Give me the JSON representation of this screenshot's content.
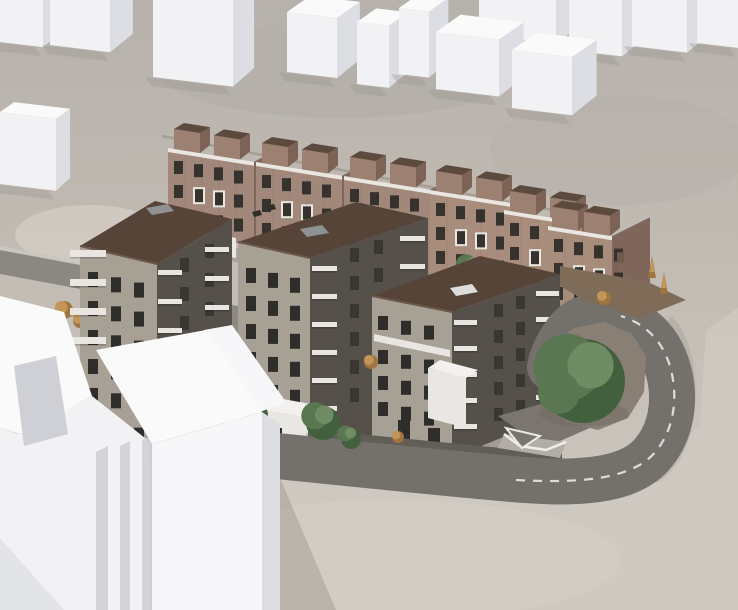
{
  "scene": {
    "canvas": {
      "w": 738,
      "h": 610
    },
    "description": "aerial architectural rendering of housing development with three stone apartment buildings, townhouse row, white context blocks and curved road",
    "palette": {
      "terrain_top": "#b5b0aa",
      "terrain_base": "#c2bcb4",
      "terrain_bottom": "#cfc9c1",
      "terrain_light": "#d6d0c8",
      "slope_shade": "#a8a29a",
      "road": "#74716c",
      "road_wall": "#cac6c0",
      "road_upper": "#8b8781",
      "lane": "#ebe9e4",
      "apron": "#615d57",
      "plaza": "#7a766f",
      "white_top": "#fafafb",
      "white_front": "#f2f2f4",
      "white_front2": "#f7f7f9",
      "white_side": "#dddee3",
      "white_recess": "#cfd0d6",
      "block_shadow": "#99948c",
      "stone_lit": "#a7a095",
      "stone_shade": "#55504a",
      "apt_roof": "#564438",
      "apt_roof_edge": "#6b5849",
      "win": "#2f2d2a",
      "win_shade": "#3a3733",
      "balcony": "#e9e6e1",
      "skylight": "#8f9192",
      "skylight_white": "#dcdcda",
      "th_front": "#a1887a",
      "th_front_warm": "#a98d7c",
      "th_side": "#7e665b",
      "th_deck": "#eae7e2",
      "th_box_top": "#5d4a3f",
      "th_box_front": "#9c8071",
      "th_box_side": "#7c6356",
      "th_win": "#36322e",
      "deck_grey": "#8d8982",
      "lowvol": "#e9e7e3",
      "lowvol_top": "#f2f1ee",
      "island_dirt": "#897f75",
      "strip_dirt": "#7e6c58",
      "g_dark": "#43603e",
      "g_mid": "#5a7751",
      "g_light": "#708c62",
      "a_dark": "#a0743f",
      "a_light": "#c29659",
      "trunk": "#4a3f35",
      "shadow_soft": "#8d887f",
      "ramp": "#b2ada5"
    },
    "terrain": {
      "patches": [
        {
          "e": [
            340,
            70,
            180,
            48
          ],
          "fill": "terrain_top",
          "op": 0.9
        },
        {
          "e": [
            620,
            150,
            130,
            55
          ],
          "fill": "terrain_top",
          "op": 0.6
        },
        {
          "e": [
            90,
            235,
            75,
            30
          ],
          "fill": "terrain_light",
          "op": 0.7
        },
        {
          "e": [
            120,
            520,
            110,
            45
          ],
          "fill": "terrain_light",
          "op": 0.4
        },
        {
          "e": [
            390,
            560,
            230,
            60
          ],
          "fill": "terrain_light",
          "op": 0.45
        }
      ],
      "bottom_field": "0,468 230,452 400,472 545,492 650,482 700,424 706,330 738,308 738,610 0,610",
      "slope_streak": "M 668,320 C 690,345 696,395 682,440 C 676,458 666,470 654,478"
    },
    "upper_road": {
      "wall": "0,246 86,262 86,266 0,250",
      "body": "0,250 86,266 86,290 0,274"
    },
    "context_blocks": [
      {
        "x": 479,
        "y": -20,
        "w": 77,
        "h": 55,
        "d": 26
      },
      {
        "x": 569,
        "y": -14,
        "w": 53,
        "h": 64,
        "d": 26
      },
      {
        "x": 632,
        "y": -16,
        "w": 55,
        "h": 62,
        "d": 26
      },
      {
        "x": 697,
        "y": -15,
        "w": 41,
        "h": 58,
        "d": 26
      },
      {
        "x": 0,
        "y": -8,
        "w": 43,
        "h": 50,
        "d": 24
      },
      {
        "x": 50,
        "y": -12,
        "w": 60,
        "h": 57,
        "d": 26
      },
      {
        "x": 153,
        "y": -18,
        "w": 80,
        "h": 95,
        "d": 24
      },
      {
        "x": 287,
        "y": 12,
        "w": 50,
        "h": 60,
        "d": 26
      },
      {
        "x": 357,
        "y": 22,
        "w": 32,
        "h": 62,
        "d": 22
      },
      {
        "x": 399,
        "y": 8,
        "w": 30,
        "h": 66,
        "d": 22
      },
      {
        "x": 436,
        "y": 32,
        "w": 63,
        "h": 57,
        "d": 28
      },
      {
        "x": 512,
        "y": 50,
        "w": 60,
        "h": 58,
        "d": 28
      },
      {
        "x": 0,
        "y": 112,
        "w": 56,
        "h": 72,
        "d": 16
      }
    ],
    "fence": {
      "x1": 162,
      "y1": 136,
      "x2": 552,
      "y2": 210
    },
    "townhouses": [
      {
        "x": 168,
        "y": 148,
        "w": 86,
        "h": 84,
        "d": 22,
        "warm": false
      },
      {
        "x": 256,
        "y": 162,
        "w": 86,
        "h": 86,
        "d": 22,
        "warm": false
      },
      {
        "x": 344,
        "y": 176,
        "w": 86,
        "h": 88,
        "d": 22,
        "warm": false
      },
      {
        "x": 430,
        "y": 190,
        "w": 84,
        "h": 88,
        "d": 22,
        "warm": true
      },
      {
        "x": 504,
        "y": 210,
        "w": 78,
        "h": 88,
        "d": 20,
        "warm": true
      },
      {
        "x": 548,
        "y": 226,
        "w": 64,
        "h": 92,
        "d": 38,
        "warm": true,
        "boff": [
          4,
          36
        ]
      }
    ],
    "terrace": "610,318 660,298 660,308 610,328",
    "row_shadow": "168,236 552,304 552,318 168,250",
    "courtyard": {
      "deckA": "158,290 248,308 248,346 158,328",
      "deckB": "428,302 468,314 468,368 428,356",
      "lowvolC": "176,226 236,238 236,258 176,246",
      "planters": [
        [
          166,
          312,
          10,
          4
        ],
        [
          180,
          318,
          12,
          4
        ],
        [
          436,
          320,
          10,
          4
        ]
      ]
    },
    "trees_back": [
      {
        "t": "g",
        "x": 212,
        "y": 248,
        "r": 10
      },
      {
        "t": "g",
        "x": 298,
        "y": 240,
        "r": 14
      },
      {
        "t": "g",
        "x": 386,
        "y": 254,
        "r": 14
      },
      {
        "t": "g",
        "x": 470,
        "y": 268,
        "r": 13
      },
      {
        "t": "g",
        "x": 524,
        "y": 306,
        "r": 14
      },
      {
        "t": "g",
        "x": 548,
        "y": 318,
        "r": 11
      },
      {
        "t": "a",
        "x": 170,
        "y": 302,
        "r": 9
      },
      {
        "t": "a",
        "x": 189,
        "y": 295,
        "r": 7
      },
      {
        "t": "a",
        "x": 64,
        "y": 310,
        "r": 9
      },
      {
        "t": "a",
        "x": 80,
        "y": 321,
        "r": 7
      },
      {
        "t": "a",
        "x": 363,
        "y": 320,
        "r": 9
      },
      {
        "t": "a",
        "x": 447,
        "y": 333,
        "r": 8
      },
      {
        "t": "a",
        "x": 610,
        "y": 298,
        "r": 7
      },
      {
        "t": "c",
        "x": 604,
        "y": 294,
        "r": 7
      }
    ],
    "apartments": [
      {
        "name": "apartment-building-left",
        "faces": [
          {
            "pts": "80,246 157,264 157,466 80,448",
            "fill": "stone_lit"
          },
          {
            "pts": "157,264 232,219 232,419 157,466",
            "fill": "stone_shade"
          },
          {
            "pts": "157,264 80,246 155,201 232,219",
            "fill": "apt_roof"
          }
        ],
        "extras": [
          {
            "line": [
              80,
              246,
              157,
              264
            ],
            "stroke": "apt_roof_edge",
            "w": 2
          },
          {
            "pts": "146,208 168,204 174,211 152,215",
            "fill": "skylight"
          }
        ],
        "windows": [
          {
            "x0": 88,
            "y0": 272,
            "cols": 3,
            "dx": 23,
            "sy": 5.3,
            "rows": 6,
            "dy": 29,
            "w": 10,
            "h": 15,
            "fill": "win"
          },
          {
            "x0": 180,
            "y0": 258,
            "cols": 2,
            "dx": 25,
            "sy": -14,
            "rows": 6,
            "dy": 29,
            "w": 9,
            "h": 14,
            "fill": "win_shade"
          }
        ],
        "slabs": [
          {
            "x": 70,
            "y": 250,
            "w": 36,
            "h": 7,
            "n": 4,
            "dy": 29
          },
          {
            "x": 158,
            "y": 270,
            "w": 24,
            "h": 5,
            "n": 6,
            "dy": 29
          },
          {
            "x": 205,
            "y": 247,
            "w": 24,
            "h": 5,
            "n": 6,
            "dy": 29
          }
        ]
      },
      {
        "name": "apartment-building-middle",
        "faces": [
          {
            "pts": "238,242 310,258 310,456 238,440",
            "fill": "stone_lit"
          },
          {
            "pts": "310,258 428,218 428,420 310,456",
            "fill": "stone_shade"
          },
          {
            "pts": "310,258 238,242 356,202 428,218",
            "fill": "apt_roof"
          }
        ],
        "extras": [
          {
            "line": [
              238,
              242,
              310,
              258
            ],
            "stroke": "apt_roof_edge",
            "w": 2
          },
          {
            "pts": "300,229 322,225 329,233 307,237",
            "fill": "skylight"
          },
          {
            "pts": "252,212 260,210 262,215 254,217",
            "fill": "win"
          },
          {
            "pts": "266,206 274,204 276,209 268,211",
            "fill": "win"
          }
        ],
        "windows": [
          {
            "x0": 246,
            "y0": 268,
            "cols": 3,
            "dx": 22,
            "sy": 4.9,
            "rows": 6,
            "dy": 28,
            "w": 10,
            "h": 15,
            "fill": "win"
          },
          {
            "x0": 350,
            "y0": 248,
            "cols": 2,
            "dx": 24,
            "sy": -8,
            "rows": 6,
            "dy": 28,
            "w": 9,
            "h": 14,
            "fill": "win_shade"
          }
        ],
        "slabs": [
          {
            "x": 312,
            "y": 266,
            "w": 25,
            "h": 5,
            "n": 6,
            "dy": 28
          },
          {
            "x": 400,
            "y": 236,
            "w": 25,
            "h": 5,
            "n": 6,
            "dy": 28
          }
        ]
      },
      {
        "name": "apartment-building-right",
        "faces": [
          {
            "pts": "372,296 452,312 452,458 372,442",
            "fill": "stone_lit"
          },
          {
            "pts": "452,312 560,274 560,414 452,458",
            "fill": "stone_shade"
          },
          {
            "pts": "452,312 372,296 480,256 560,274",
            "fill": "apt_roof"
          }
        ],
        "extras": [
          {
            "line": [
              372,
              296,
              452,
              312
            ],
            "stroke": "apt_roof_edge",
            "w": 2
          },
          {
            "pts": "450,288 472,284 478,292 456,296",
            "fill": "skylight_white"
          },
          {
            "pts": "374,334 450,350 450,357 374,341",
            "fill": "balcony"
          },
          {
            "r": [
              398,
              420,
              12,
              22
            ],
            "fill": "win"
          },
          {
            "r": [
              428,
              428,
              12,
              20
            ],
            "fill": "win"
          },
          {
            "pts": "452,458 560,414 572,420 462,466",
            "fill": "#4a463f",
            "op": 0.3
          }
        ],
        "windows": [
          {
            "x0": 378,
            "y0": 316,
            "cols": 3,
            "dx": 23,
            "sy": 4.8,
            "rows": 1,
            "dy": 26,
            "w": 10,
            "h": 14,
            "fill": "win"
          },
          {
            "x0": 378,
            "y0": 350,
            "cols": 3,
            "dx": 23,
            "sy": 4.8,
            "rows": 3,
            "dy": 26,
            "w": 10,
            "h": 14,
            "fill": "win"
          },
          {
            "x0": 494,
            "y0": 304,
            "cols": 2,
            "dx": 22,
            "sy": -8,
            "rows": 5,
            "dy": 26,
            "w": 9,
            "h": 13,
            "fill": "win_shade"
          }
        ],
        "slabs": [
          {
            "x": 454,
            "y": 320,
            "w": 23,
            "h": 5,
            "n": 5,
            "dy": 26
          },
          {
            "x": 536,
            "y": 291,
            "w": 23,
            "h": 5,
            "n": 5,
            "dy": 26
          }
        ]
      }
    ],
    "street": {
      "apron": "236,422 562,454 562,472 236,440",
      "lowvolA_top": "252,408 308,418 322,406 266,396",
      "lowvolA": "252,408 308,418 308,468 252,458",
      "lowvolA_door": [
        272,
        428,
        10,
        24
      ],
      "lowvolB_top": "428,368 466,378 478,370 440,360",
      "lowvolB": "428,368 466,378 466,428 428,418",
      "plaza": "498,416 562,398 608,420 544,448",
      "ramp": "504,434 566,442 560,458 498,448",
      "rail": "504,434 520,446 546,450 566,442",
      "marks": "M 506,428 L 540,436 L 522,448 Z"
    },
    "road": {
      "main": "M 226,451 C 330,461 440,473 524,480 C 590,485 634,478 654,452 C 671,431 676,401 669,373 C 662,345 646,327 622,319 C 599,311 578,317 566,333 C 557,345 552,357 550,367",
      "width": 46,
      "dash": "M 516,480 C 590,484 636,477 657,450 C 674,428 678,398 671,370 C 664,342 646,324 621,316",
      "island": "548,346 574,328 604,322 632,334 646,356 644,392 628,418 598,430 566,422 550,398 542,370",
      "strip": "560,266 648,282 686,300 640,318 584,300 560,286"
    },
    "trees_front": [
      {
        "t": "g",
        "x": 252,
        "y": 412,
        "r": 13
      },
      {
        "t": "g",
        "x": 320,
        "y": 420,
        "r": 17
      },
      {
        "t": "g",
        "x": 348,
        "y": 436,
        "r": 10
      },
      {
        "t": "a",
        "x": 398,
        "y": 437,
        "r": 6
      },
      {
        "t": "a",
        "x": 371,
        "y": 362,
        "r": 7
      },
      {
        "t": "big",
        "x": 580,
        "y": 378,
        "r": 42
      },
      {
        "t": "c",
        "x": 652,
        "y": 270,
        "r": 10
      },
      {
        "t": "c",
        "x": 664,
        "y": 286,
        "r": 8
      },
      {
        "t": "a",
        "x": 604,
        "y": 298,
        "r": 7
      }
    ],
    "foreground": {
      "w1_top": "0,296 64,312 92,396 20,434 0,428",
      "w1_recess": "14,366 56,356 68,434 24,446",
      "w1_front": "0,428 18,434 92,396 150,442 150,610 0,610",
      "stripes": [
        "96,452 108,446 108,610 96,610",
        "120,446 130,441 130,610 120,610",
        "142,440 152,436 152,610 142,610"
      ],
      "w2_step": "204,330 232,325 286,402 260,412",
      "w2_top": "96,350 206,330 262,412 152,444",
      "w2_front": "152,444 262,412 262,610 152,610",
      "w2_side": "262,412 280,424 280,610 262,610",
      "shadow_right": "280,478 336,610 280,610",
      "shadow_left": "0,538 64,610 0,610"
    }
  }
}
